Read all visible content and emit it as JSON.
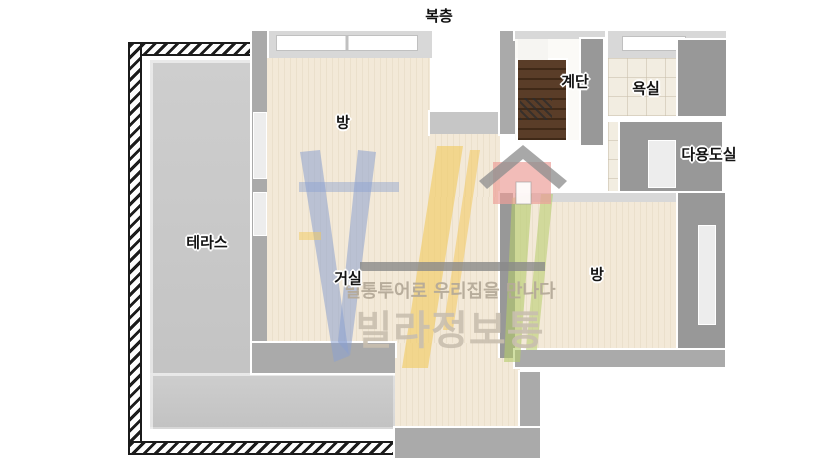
{
  "title": "복층",
  "rooms": [
    {
      "id": "terrace",
      "label": "테라스"
    },
    {
      "id": "room-top",
      "label": "방"
    },
    {
      "id": "living",
      "label": "거실"
    },
    {
      "id": "stairs",
      "label": "계단"
    },
    {
      "id": "bathroom",
      "label": "욕실"
    },
    {
      "id": "utility",
      "label": "다용도실"
    },
    {
      "id": "room-right",
      "label": "방"
    }
  ],
  "watermark": {
    "tagline": "빌통투어로 우리집을 만나다",
    "brand": "빌라정보통"
  },
  "colors": {
    "floor_wood": "#f3e9d8",
    "floor_tile": "#f2ede1",
    "terrace_floor": "#c6c6c6",
    "wall_dark": "#989898",
    "wall_light": "#d8d8d8",
    "stair_wood": "#4b3322",
    "logo_blue": "#8aa0d0",
    "logo_yellow": "#f2c95c",
    "logo_green": "#b4cc6a",
    "logo_house_pink": "#eda09a",
    "logo_roof_gray": "#8f8f8f",
    "watermark_text": "#c9bfaf"
  }
}
